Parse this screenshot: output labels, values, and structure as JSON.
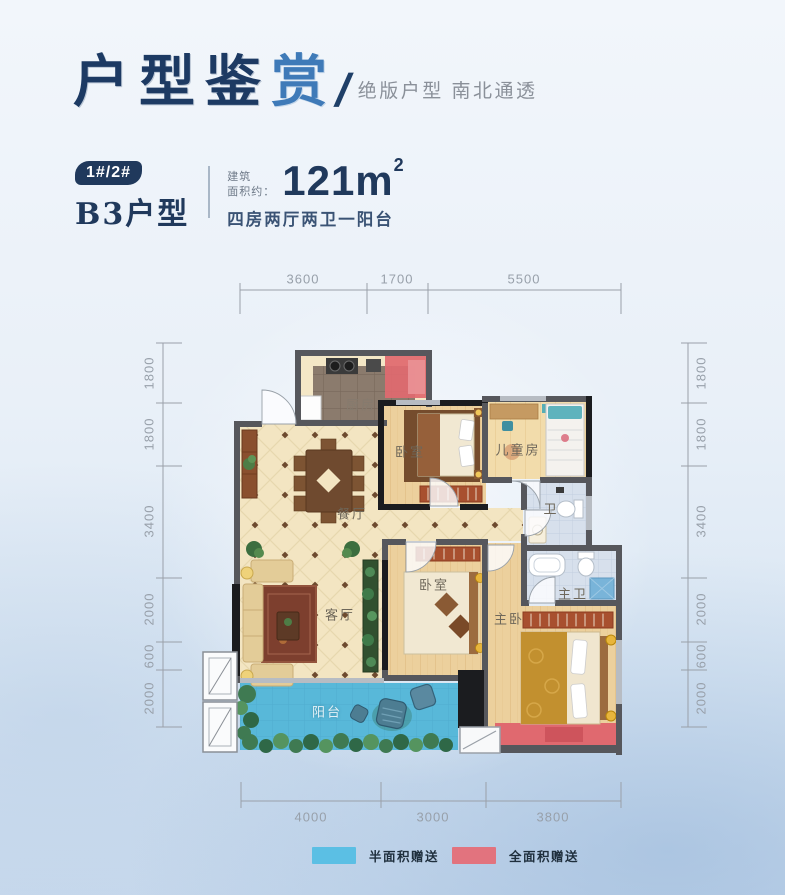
{
  "header": {
    "title_main": "户型鉴",
    "title_accent": "赏",
    "slash": "/",
    "subtitle": "绝版户型 南北通透"
  },
  "unit": {
    "badge": "1#/2#",
    "name": "B3户型",
    "area_label_line1": "建筑",
    "area_label_line2": "面积约：",
    "area_value": "121m",
    "area_unit_sup": "2",
    "layout_desc": "四房两厅两卫一阳台"
  },
  "floorplan": {
    "rooms": {
      "kitchen": "厨房",
      "dining": "餐厅",
      "living": "客厅",
      "bedroom_top": "卧室",
      "bedroom_mid": "卧室",
      "kids_room": "儿童房",
      "bath": "卫",
      "master_bath": "主卫",
      "master_bedroom": "主卧",
      "balcony": "阳台"
    },
    "dims": {
      "top": [
        "3600",
        "1700",
        "5500"
      ],
      "bottom": [
        "4000",
        "3000",
        "3800"
      ],
      "left": [
        "1800",
        "1800",
        "3400",
        "2000",
        "600",
        "2000"
      ],
      "right": [
        "1800",
        "1800",
        "3400",
        "2000",
        "600",
        "2000"
      ]
    }
  },
  "legend": {
    "items": [
      {
        "label": "半面积赠送",
        "color": "#5bbfe4"
      },
      {
        "label": "全面积赠送",
        "color": "#e2737e"
      }
    ]
  },
  "colors": {
    "title_navy": "#1d3a63",
    "title_accent_blue": "#3f7ab8",
    "subtitle_gray": "#8a9099",
    "badge_navy": "#20395c",
    "dim_gray": "#98a0aa",
    "balcony_blue": "#58b8d9",
    "gift_red": "#e0696f"
  }
}
